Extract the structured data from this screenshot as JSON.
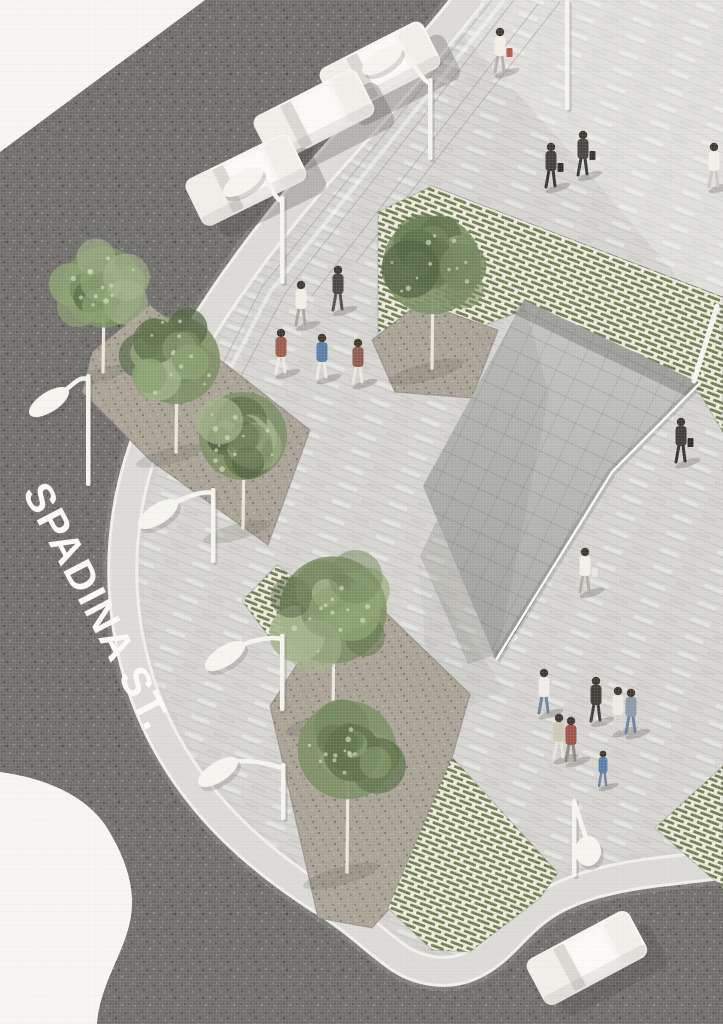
{
  "scene": {
    "type": "architectural site rendering",
    "view": "axonometric plaza rendering with street, sidewalk, trees and pavilion"
  },
  "street_label": "SPADINA ST.",
  "colors": {
    "paper": "#f6f5f1",
    "asphalt": "#6f6e6b",
    "plaza": "#d6d5d1",
    "sidewalk": "#dcdad6",
    "curb": "#f0efeb",
    "soil": "#a8a195",
    "green_paver": "#6f7c51",
    "green_paver_joint": "#eae8da",
    "roof_light": "#c3c4c0",
    "roof_dark": "#a7a8a4",
    "timber": "#b9996f",
    "tree_greens": [
      "#5d7048",
      "#73865c",
      "#8aa070",
      "#a2b489",
      "#4f6240"
    ],
    "trunk": "#eae7de",
    "lamp_white": "#f5f4ef",
    "figure_white": "#f1efe8"
  },
  "areas": {
    "road": "asphalt street",
    "plaza": "paved pedestrian plaza",
    "sidewalk": "curved sidewalk",
    "green_zones": "permeable green paver patches",
    "planting_beds": "soil planting beds with trees",
    "pavilion": "triangular shingled-roof pavilion with timber and glass base"
  },
  "trees": [
    {
      "x": 103,
      "y": 287,
      "r": 46,
      "baseY": 372
    },
    {
      "x": 176,
      "y": 360,
      "r": 50,
      "baseY": 452
    },
    {
      "x": 243,
      "y": 436,
      "r": 50,
      "baseY": 528
    },
    {
      "x": 432,
      "y": 265,
      "r": 56,
      "baseY": 368
    },
    {
      "x": 333,
      "y": 610,
      "r": 61,
      "baseY": 718
    },
    {
      "x": 347,
      "y": 750,
      "r": 56,
      "baseY": 872
    }
  ],
  "lamps": [
    {
      "type": "spoon",
      "px": 428,
      "py": 78,
      "h": 82,
      "hx": 382,
      "hy": 60
    },
    {
      "type": "spoon",
      "px": 280,
      "py": 196,
      "h": 88,
      "hx": 243,
      "hy": 182
    },
    {
      "type": "spoon",
      "px": 86,
      "py": 374,
      "h": 112,
      "hx": 49,
      "hy": 402
    },
    {
      "type": "spoon",
      "px": 211,
      "py": 488,
      "h": 75,
      "hx": 158,
      "hy": 514
    },
    {
      "type": "spoon",
      "px": 280,
      "py": 634,
      "h": 77,
      "hx": 225,
      "hy": 656
    },
    {
      "type": "spoon",
      "px": 281,
      "py": 763,
      "h": 57,
      "hx": 218,
      "hy": 772
    },
    {
      "type": "drop",
      "px": 572,
      "py": 799,
      "h": 78,
      "hx": 588,
      "hy": 851
    },
    {
      "type": "post",
      "px": 565,
      "py": 0,
      "h": 110
    }
  ],
  "cars": [
    {
      "x": 380,
      "y": 68,
      "rot": -27
    },
    {
      "x": 314,
      "y": 116,
      "rot": -27
    },
    {
      "x": 246,
      "y": 180,
      "rot": -26
    },
    {
      "x": 587,
      "y": 958,
      "rot": -28
    }
  ],
  "people": [
    {
      "x": 500,
      "y": 72,
      "shirt": "#f1efe8",
      "pants": "#b3b1aa",
      "bag": "#b5574d"
    },
    {
      "x": 551,
      "y": 187,
      "shirt": "#413f3b",
      "pants": "#35332f",
      "bag": "#2f2d2a"
    },
    {
      "x": 583,
      "y": 175,
      "shirt": "#474440",
      "pants": "#3b3935",
      "bag": "#33312d"
    },
    {
      "x": 714,
      "y": 187,
      "shirt": "#f2f0e9",
      "pants": "#c9c7c0"
    },
    {
      "x": 301,
      "y": 325,
      "shirt": "#f0eee7",
      "pants": "#a7a59d"
    },
    {
      "x": 338,
      "y": 310,
      "shirt": "#4a4540",
      "pants": "#55504a"
    },
    {
      "x": 281,
      "y": 373,
      "shirt": "#9d5a50",
      "pants": "#eceae2"
    },
    {
      "x": 322,
      "y": 378,
      "shirt": "#5a7ea8",
      "pants": "#eceae2"
    },
    {
      "x": 358,
      "y": 383,
      "shirt": "#8e5a52",
      "pants": "#e9e7df"
    },
    {
      "x": 681,
      "y": 462,
      "shirt": "#3f3d39",
      "pants": "#34322e",
      "bag": "#2e2c29"
    },
    {
      "x": 585,
      "y": 592,
      "shirt": "#f2f0e9",
      "pants": "#b0aea6",
      "bag": "#e8e6dd"
    },
    {
      "x": 544,
      "y": 713,
      "shirt": "#efede6",
      "pants": "#6d829c"
    },
    {
      "x": 596,
      "y": 721,
      "shirt": "#413e39",
      "pants": "#413e39"
    },
    {
      "x": 618,
      "y": 731,
      "shirt": "#eceae3",
      "pants": "#d8d6cf"
    },
    {
      "x": 631,
      "y": 733,
      "shirt": "#8d99a7",
      "pants": "#6d829c"
    },
    {
      "x": 559,
      "y": 758,
      "shirt": "#cfc7b4",
      "pants": "#e6e4dc"
    },
    {
      "x": 571,
      "y": 761,
      "shirt": "#a0524a",
      "pants": "#8b8880"
    },
    {
      "x": 603,
      "y": 786,
      "shirt": "#5a7ea8",
      "pants": "#6d829c",
      "s": 0.8
    }
  ]
}
